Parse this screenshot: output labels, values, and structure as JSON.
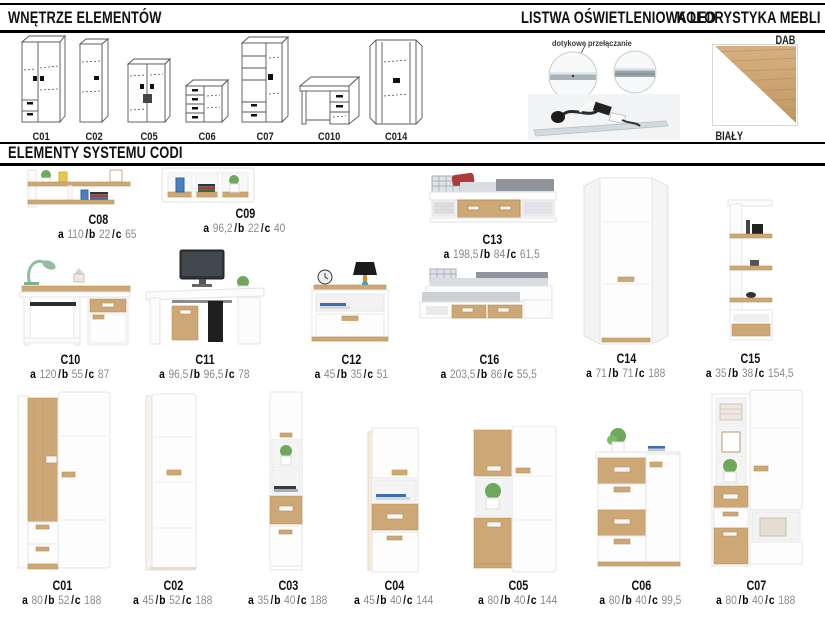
{
  "headers": {
    "interiors": "WNĘTRZE ELEMENTÓW",
    "led": "LISTWA OŚWIETLENIOWA LED",
    "colors": "KOLORYSTYKA MEBLI",
    "elements": "ELEMENTY SYSTEMU CODI"
  },
  "interiors": {
    "items": [
      {
        "code": "C01"
      },
      {
        "code": "C02"
      },
      {
        "code": "C05"
      },
      {
        "code": "C06"
      },
      {
        "code": "C07"
      },
      {
        "code": "C010"
      },
      {
        "code": "C014"
      }
    ]
  },
  "led": {
    "caption": "dotykowe przełączanie"
  },
  "colors": {
    "top_label": "DAB",
    "bottom_label": "BIAŁY",
    "oak_hex": "#c9a470",
    "white_hex": "#ffffff"
  },
  "dim_labels": {
    "a": "a",
    "b": "b",
    "c": "c",
    "sep": "/"
  },
  "products": [
    {
      "code": "C08",
      "dims": [
        "110",
        "22",
        "65"
      ]
    },
    {
      "code": "C09",
      "dims": [
        "96,2",
        "22",
        "40"
      ]
    },
    {
      "code": "C13",
      "dims": [
        "198,5",
        "84",
        "61,5"
      ]
    },
    {
      "code": "C14",
      "dims": [
        "71",
        "71",
        "188"
      ]
    },
    {
      "code": "C15",
      "dims": [
        "35",
        "38",
        "154,5"
      ]
    },
    {
      "code": "C10",
      "dims": [
        "120",
        "55",
        "87"
      ]
    },
    {
      "code": "C11",
      "dims": [
        "96,5",
        "96,5",
        "78"
      ]
    },
    {
      "code": "C12",
      "dims": [
        "45",
        "35",
        "51"
      ]
    },
    {
      "code": "C16",
      "dims": [
        "203,5",
        "86",
        "55,5"
      ]
    },
    {
      "code": "C01",
      "dims": [
        "80",
        "52",
        "188"
      ]
    },
    {
      "code": "C02",
      "dims": [
        "45",
        "52",
        "188"
      ]
    },
    {
      "code": "C03",
      "dims": [
        "35",
        "40",
        "188"
      ]
    },
    {
      "code": "C04",
      "dims": [
        "45",
        "40",
        "144"
      ]
    },
    {
      "code": "C05",
      "dims": [
        "80",
        "40",
        "144"
      ]
    },
    {
      "code": "C06",
      "dims": [
        "80",
        "40",
        "99,5"
      ]
    },
    {
      "code": "C07",
      "dims": [
        "80",
        "40",
        "188"
      ]
    }
  ]
}
